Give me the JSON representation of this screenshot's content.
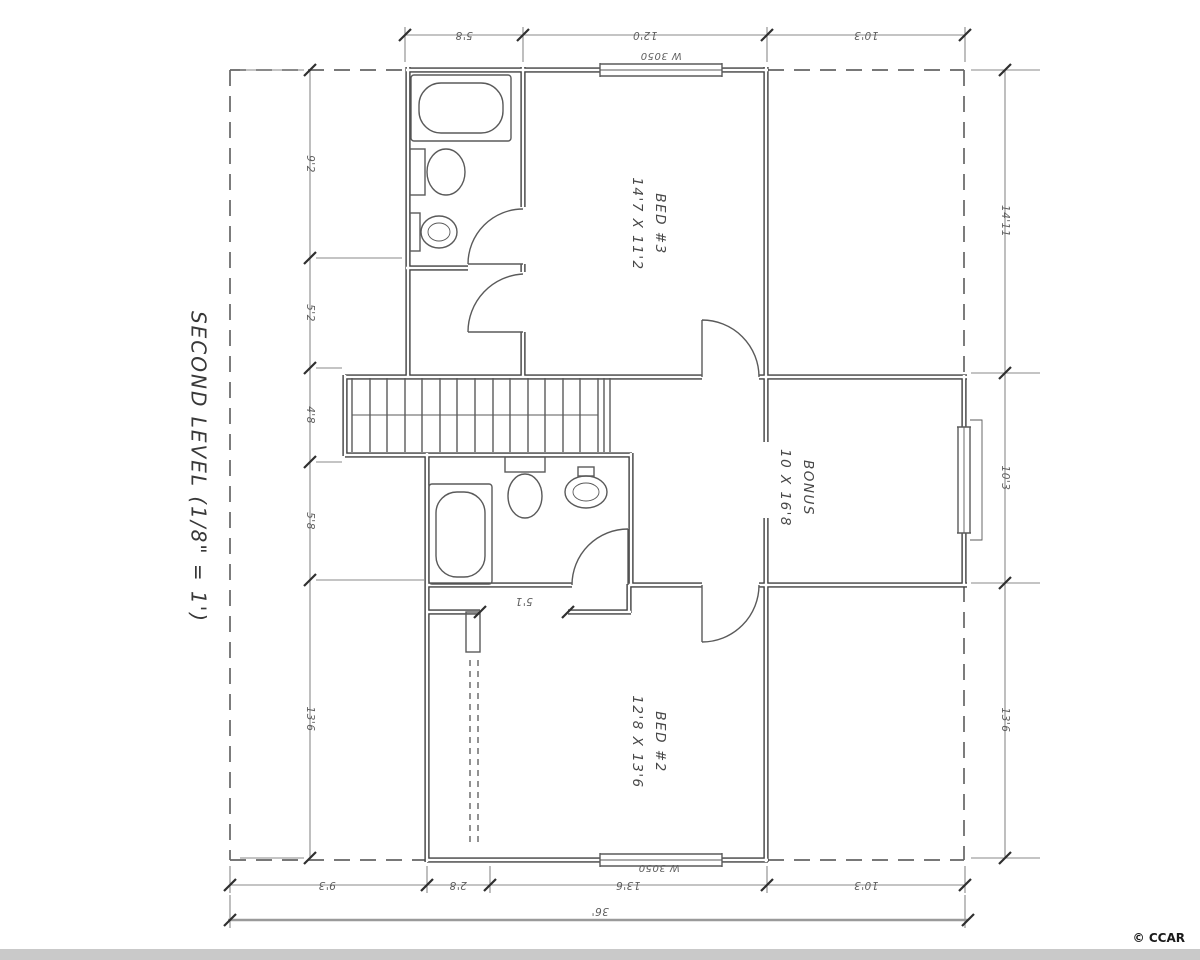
{
  "title": "SECOND LEVEL (1/8\" = 1')",
  "rooms": {
    "bed3": {
      "name": "BED #3",
      "dims": "14'7 X 11'2"
    },
    "bonus": {
      "name": "BONUS",
      "dims": "10 X 16'8"
    },
    "bed2": {
      "name": "BED #2",
      "dims": "12'8 X 13'6"
    }
  },
  "windows": {
    "top_label": "W 3050",
    "bottom_label": "W 3050"
  },
  "dimensions": {
    "top": [
      "5'8",
      "12'0",
      "10'3"
    ],
    "bottom": [
      "9'3",
      "2'8",
      "13'6",
      "10'3"
    ],
    "left": [
      "9'2",
      "5'2",
      "4'8",
      "5'8",
      "13'6"
    ],
    "right": [
      "14'11",
      "10'3",
      "13'6"
    ],
    "overall_width": "36'",
    "closet": "5'1"
  },
  "watermark": "© CCAR",
  "colors": {
    "wall": "#3f3f3f",
    "thin_line": "#5a5a5a",
    "dim_line": "#8a8a8a",
    "text": "#5f5f5f",
    "band": "#c9c9c9"
  }
}
